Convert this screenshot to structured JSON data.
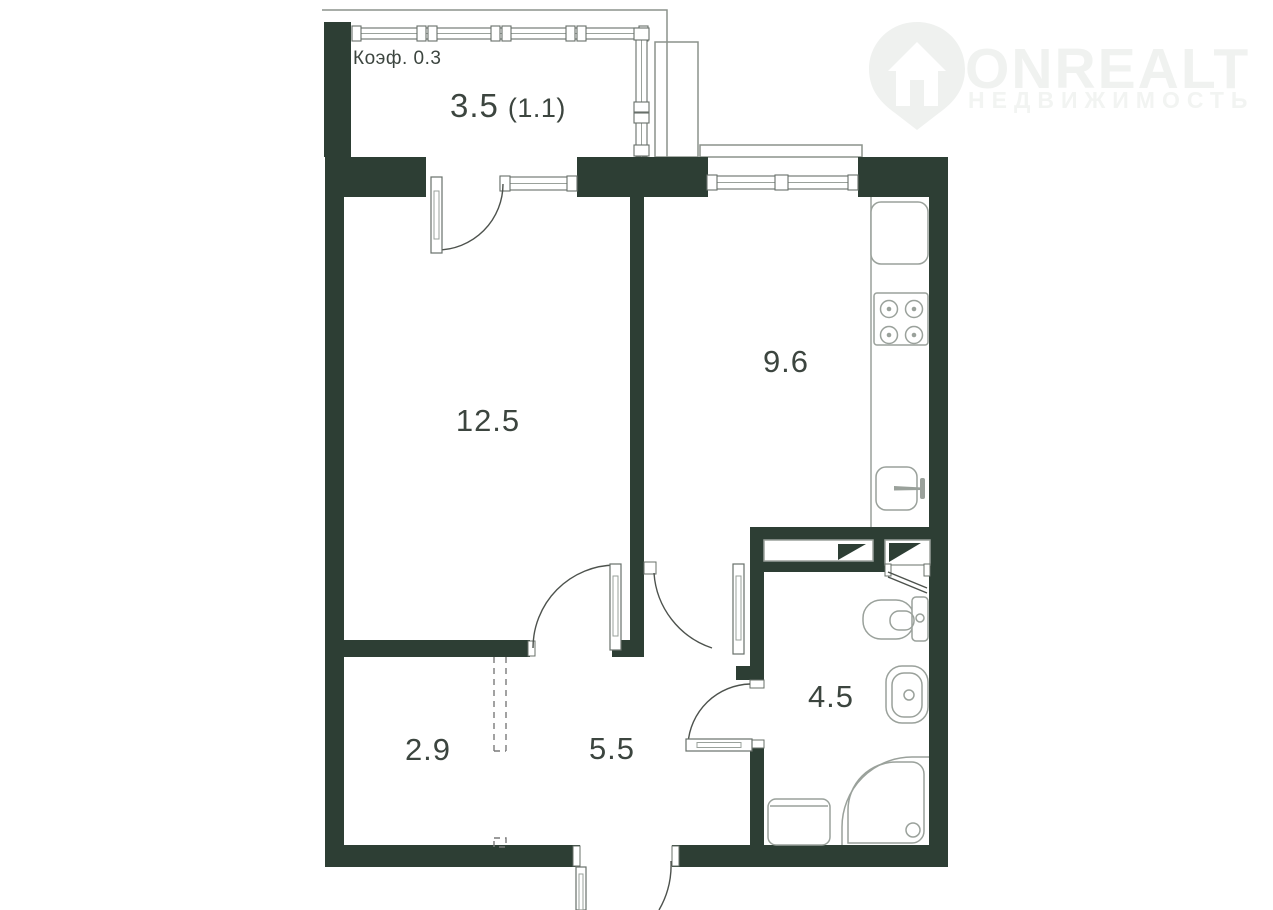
{
  "watermark": {
    "brand": "ONREALT",
    "tagline": "НЕДВИЖИМОСТЬ"
  },
  "plan": {
    "type": "apartment-floor-plan",
    "coefficient_label": "Коэф. 0.3",
    "rooms": {
      "living_room": {
        "area": "12.5"
      },
      "kitchen": {
        "area": "9.6"
      },
      "bathroom": {
        "area": "4.5"
      },
      "hallway": {
        "area": "5.5"
      },
      "closet": {
        "area": "2.9"
      },
      "balcony": {
        "area": "3.5",
        "coefficient_area": "(1.1)"
      }
    },
    "fixtures": [
      "fridge",
      "stove-4-burners",
      "kitchen-sink",
      "toilet",
      "washbasin",
      "shower-tray",
      "washing-machine",
      "vent-shaft",
      "vent-shaft",
      "wardrobe-dashed-outline",
      "balcony-glazing",
      "windows",
      "doors"
    ]
  },
  "colors": {
    "background": "#ffffff",
    "wall": "#2d3e34",
    "label_text": "#3c453f",
    "fixture_line": "#9aa19b",
    "door_line": "#4d524d",
    "window_line": "#68706a",
    "dashed_line": "#7a7a7a",
    "watermark": "#f0f2f0"
  }
}
